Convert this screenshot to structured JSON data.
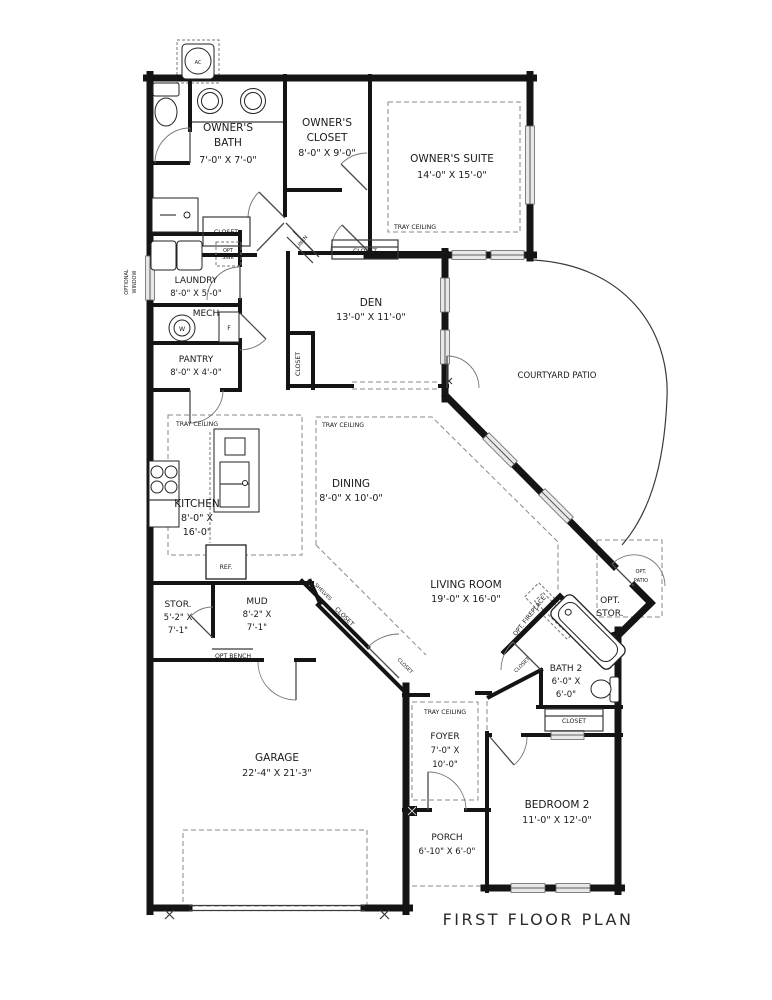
{
  "title": "FIRST FLOOR PLAN",
  "colors": {
    "wall": "#141414",
    "window_fill": "#e8e8e8",
    "dashed": "#8a8a8a",
    "text": "#1a1a1a",
    "bg": "#ffffff"
  },
  "rooms": {
    "owners_bath": {
      "lines": [
        "OWNER'S",
        "BATH",
        "7'-0\" X 7'-0\""
      ]
    },
    "owners_closet": {
      "lines": [
        "OWNER'S",
        "CLOSET",
        "8'-0\" X 9'-0\""
      ]
    },
    "owners_suite": {
      "lines": [
        "OWNER'S SUITE",
        "14'-0\" X 15'-0\""
      ]
    },
    "laundry": {
      "lines": [
        "LAUNDRY",
        "8'-0\" X 5'-0\""
      ]
    },
    "mech": {
      "lines": [
        "MECH"
      ]
    },
    "pantry": {
      "lines": [
        "PANTRY",
        "8'-0\" X 4'-0\""
      ]
    },
    "den": {
      "lines": [
        "DEN",
        "13'-0\" X 11'-0\""
      ]
    },
    "courtyard_patio": {
      "lines": [
        "COURTYARD PATIO"
      ]
    },
    "kitchen": {
      "lines": [
        "KITCHEN",
        "8'-0\" X",
        "16'-0\""
      ]
    },
    "dining": {
      "lines": [
        "DINING",
        "8'-0\" X 10'-0\""
      ]
    },
    "living_room": {
      "lines": [
        "LIVING ROOM",
        "19'-0\" X 16'-0\""
      ]
    },
    "stor": {
      "lines": [
        "STOR.",
        "5'-2\" X",
        "7'-1\""
      ]
    },
    "mud": {
      "lines": [
        "MUD",
        "8'-2\" X",
        "7'-1\""
      ]
    },
    "garage": {
      "lines": [
        "GARAGE",
        "22'-4\" X 21'-3\""
      ]
    },
    "foyer": {
      "lines": [
        "FOYER",
        "7'-0\" X",
        "10'-0\""
      ]
    },
    "porch": {
      "lines": [
        "PORCH",
        "6'-10\" X 6'-0\""
      ]
    },
    "bath2": {
      "lines": [
        "BATH 2",
        "6'-0\" X",
        "6'-0\""
      ]
    },
    "bedroom2": {
      "lines": [
        "BEDROOM 2",
        "11'-0\" X 12'-0\""
      ]
    },
    "opt_stor": {
      "lines": [
        "OPT.",
        "STOR."
      ]
    },
    "opt_patio": {
      "lines": [
        "OPT.",
        "PATIO"
      ]
    }
  },
  "annotations": {
    "tray_ceiling": "TRAY CEILING",
    "closet": "CLOSET",
    "opt_sink_1": "OPT",
    "opt_sink_2": "SINK",
    "opt_bench": "OPT BENCH",
    "optional_window_1": "OPTIONAL",
    "optional_window_2": "WINDOW",
    "linen": "LINEN",
    "shelves": "SHELVES",
    "opt_fireplace": "OPT. FIREPLACE",
    "ref": "REF."
  },
  "fixtures": {
    "ac_label": "AC",
    "water_heater_label": "W",
    "furnace_label": "F"
  }
}
